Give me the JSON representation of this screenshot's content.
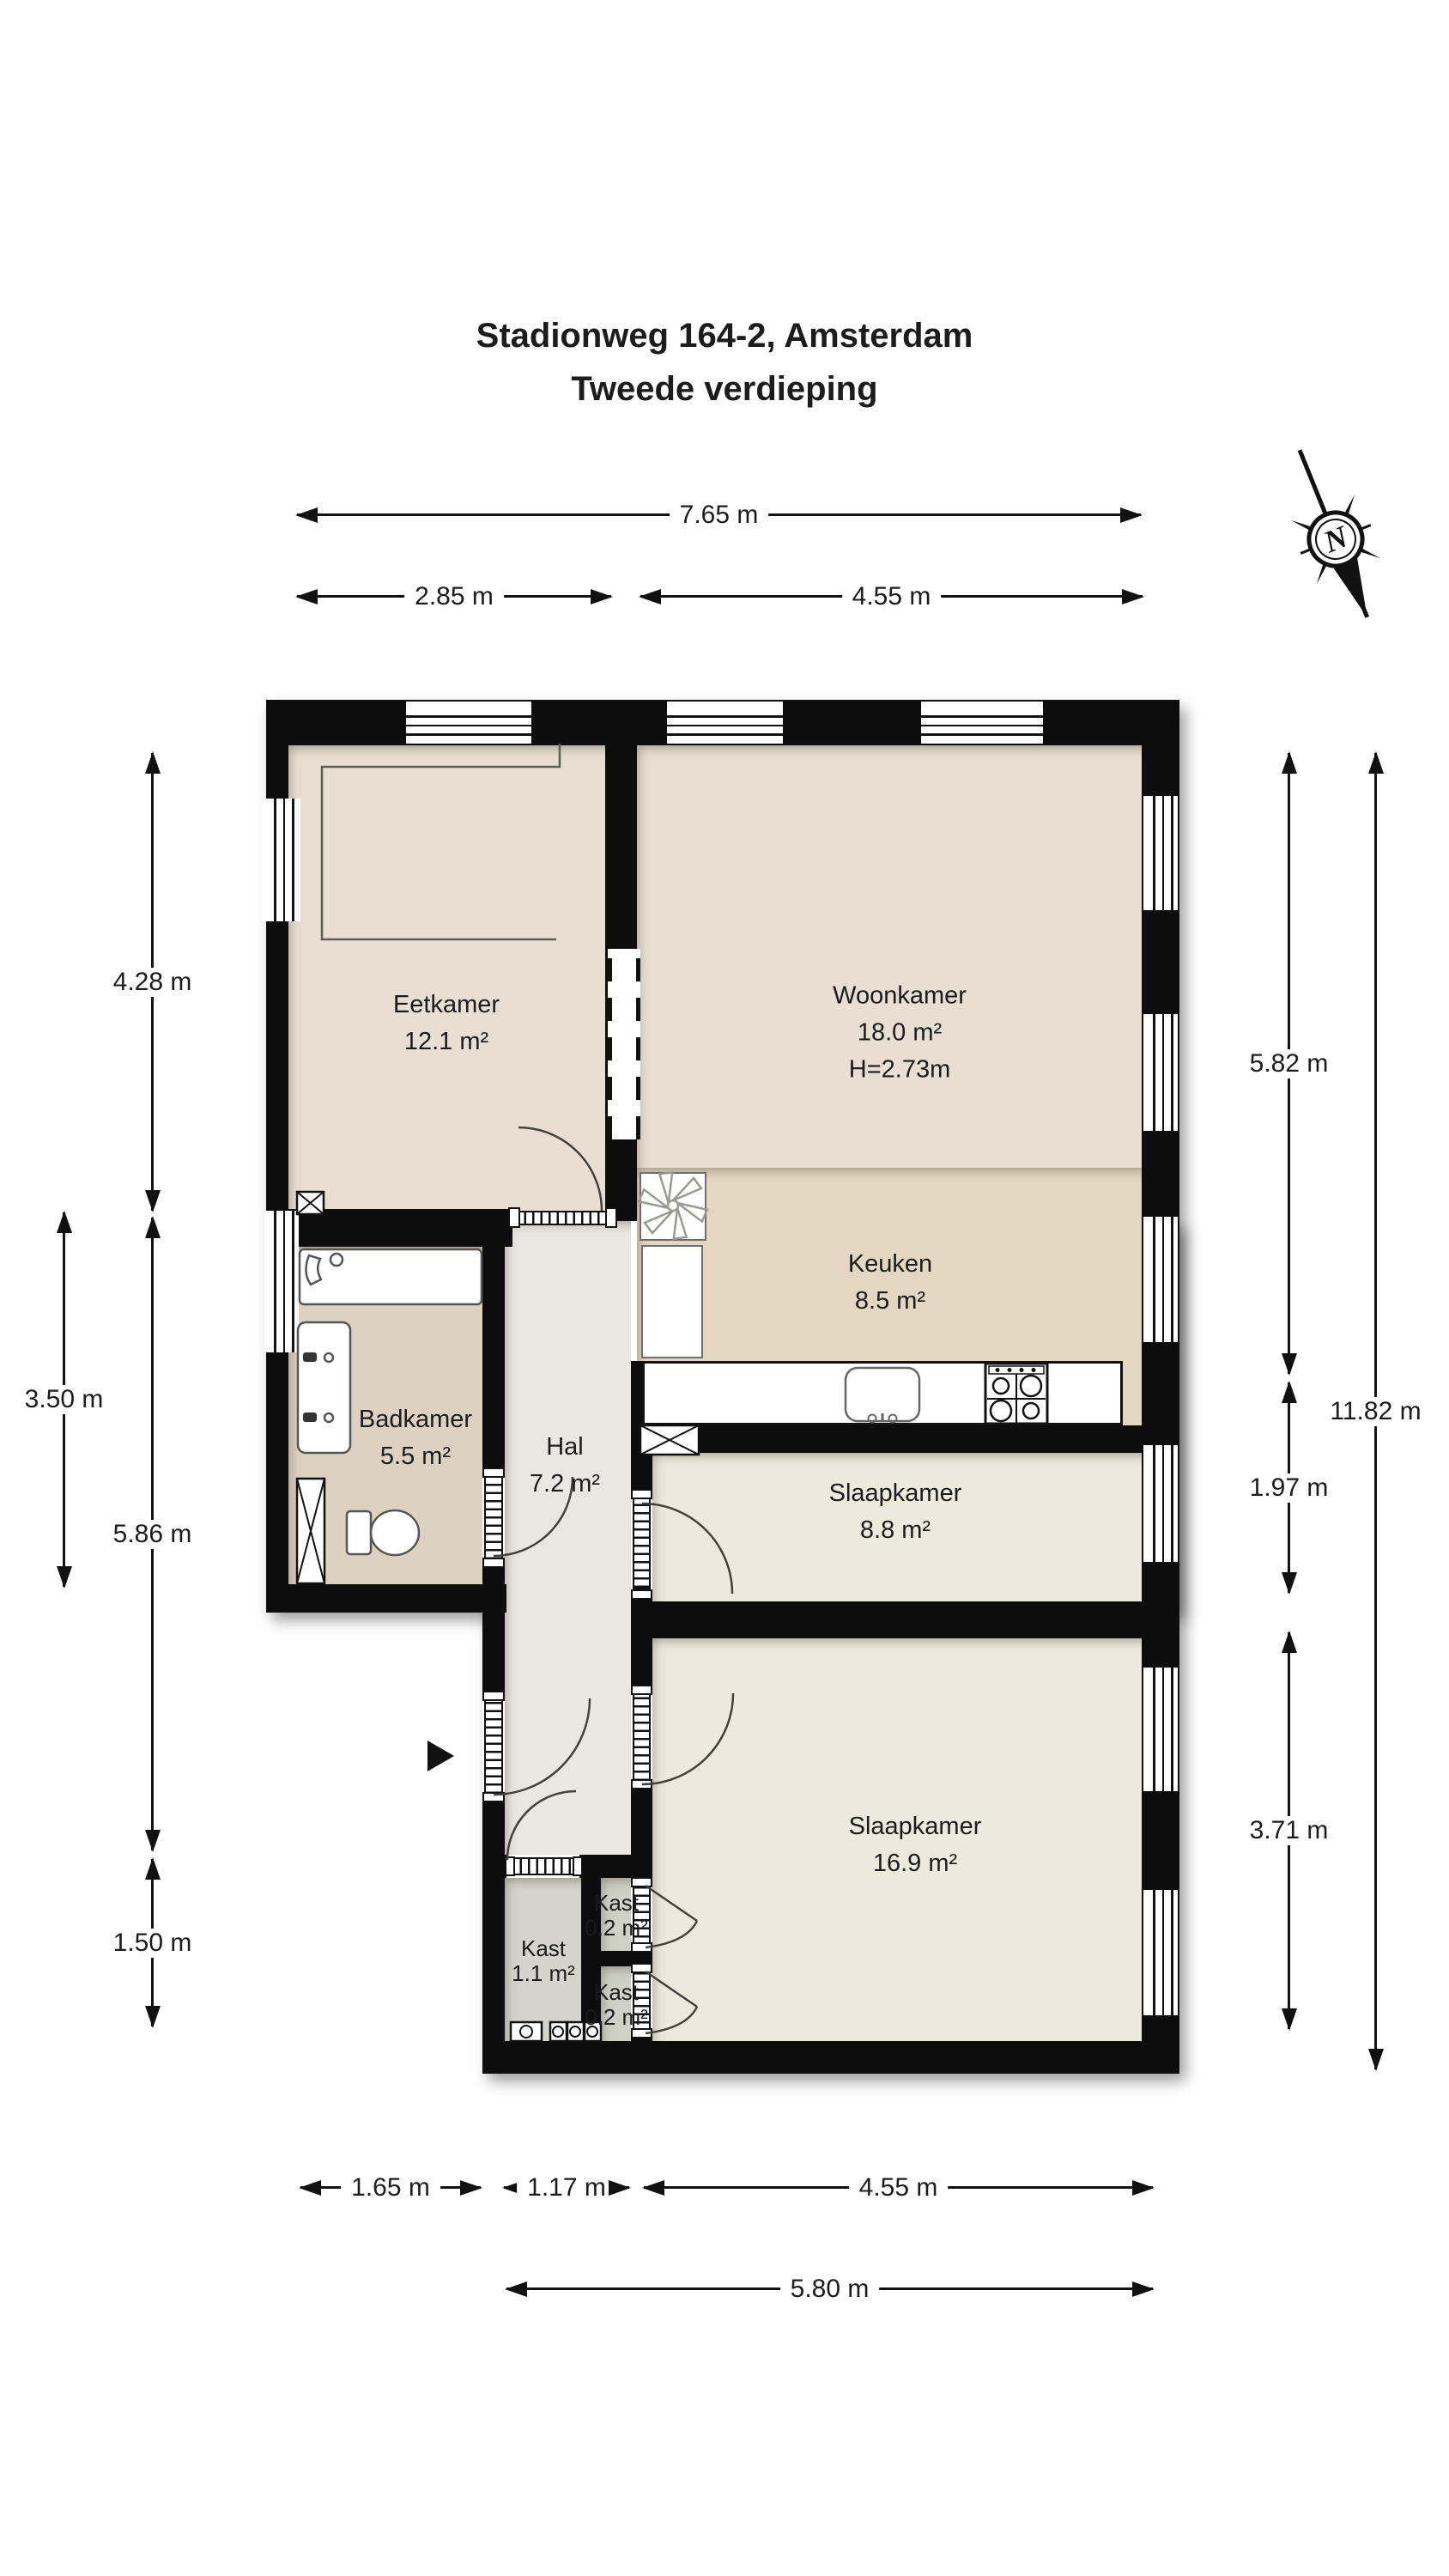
{
  "title": {
    "line1": "Stadionweg 164-2, Amsterdam",
    "line2": "Tweede verdieping"
  },
  "compass": {
    "label": "N"
  },
  "rooms": {
    "eetkamer": {
      "name": "Eetkamer",
      "area": "12.1 m²"
    },
    "woonkamer": {
      "name": "Woonkamer",
      "area": "18.0 m²",
      "ceiling_height": "H=2.73m"
    },
    "keuken": {
      "name": "Keuken",
      "area": "8.5 m²"
    },
    "badkamer": {
      "name": "Badkamer",
      "area": "5.5 m²"
    },
    "hal": {
      "name": "Hal",
      "area": "7.2 m²"
    },
    "slaapkamer_achter": {
      "name": "Slaapkamer",
      "area": "8.8 m²"
    },
    "slaapkamer_voor": {
      "name": "Slaapkamer",
      "area": "16.9 m²"
    },
    "kast_hal": {
      "name": "Kast",
      "area": "1.1 m²"
    },
    "kast_boven": {
      "name": "Kast",
      "area": "0.2 m²"
    },
    "kast_onder": {
      "name": "Kast",
      "area": "0.2 m²"
    }
  },
  "dimensions": {
    "top_total": "7.65 m",
    "top_left": "2.85 m",
    "top_right": "4.55 m",
    "left_eetkamer": "4.28 m",
    "left_badkamer": "3.50 m",
    "left_hal": "5.86 m",
    "left_kast": "1.50 m",
    "right_woonkamer": "5.82 m",
    "right_slaapkamer_achter": "1.97 m",
    "right_slaapkamer_voor": "3.71 m",
    "right_total": "11.82 m",
    "bottom_badkamer": "1.65 m",
    "bottom_hal": "1.17 m",
    "bottom_slaapkamer": "4.55 m",
    "bottom_total": "5.80 m"
  },
  "colors": {
    "wall": "#0d0d0d",
    "floor_living": "#e8dfd2",
    "floor_kitchen": "#e3d7c1",
    "floor_bathroom": "#ddd2c2",
    "floor_hall": "#e9e7e1",
    "floor_bedroom": "#edeadd",
    "floor_closet": "#d4d4cc",
    "text": "#1c1c1c"
  }
}
